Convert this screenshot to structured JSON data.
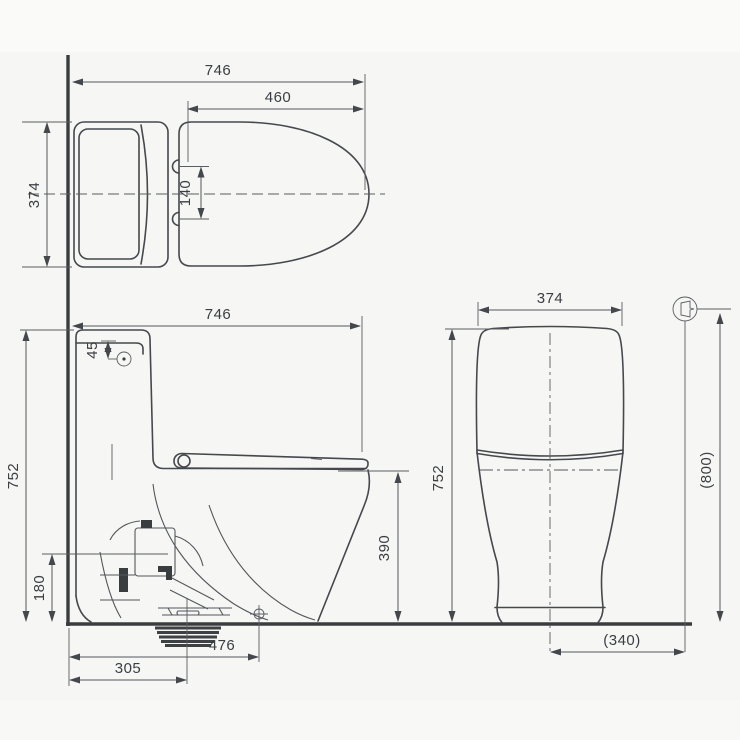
{
  "drawing": {
    "units": "mm",
    "background_color": "#f6f6f4",
    "line_color": "#45484c",
    "views": {
      "top": {
        "dims": {
          "overall_length": "746",
          "seat_length": "460",
          "overall_width": "374",
          "hinge_spacing": "140"
        }
      },
      "side": {
        "dims": {
          "overall_depth": "746",
          "button_offset": "45",
          "overall_height": "752",
          "outlet_height": "180",
          "bowl_height": "390",
          "wall_to_fixing": "476",
          "wall_to_outlet": "305"
        }
      },
      "front": {
        "dims": {
          "overall_width": "374",
          "overall_height": "752",
          "supply_height": "(800)",
          "supply_offset": "(340)"
        }
      }
    },
    "symbols": {
      "water_supply": "water-supply-symbol",
      "fixing_point": "position-cross-mark"
    }
  }
}
